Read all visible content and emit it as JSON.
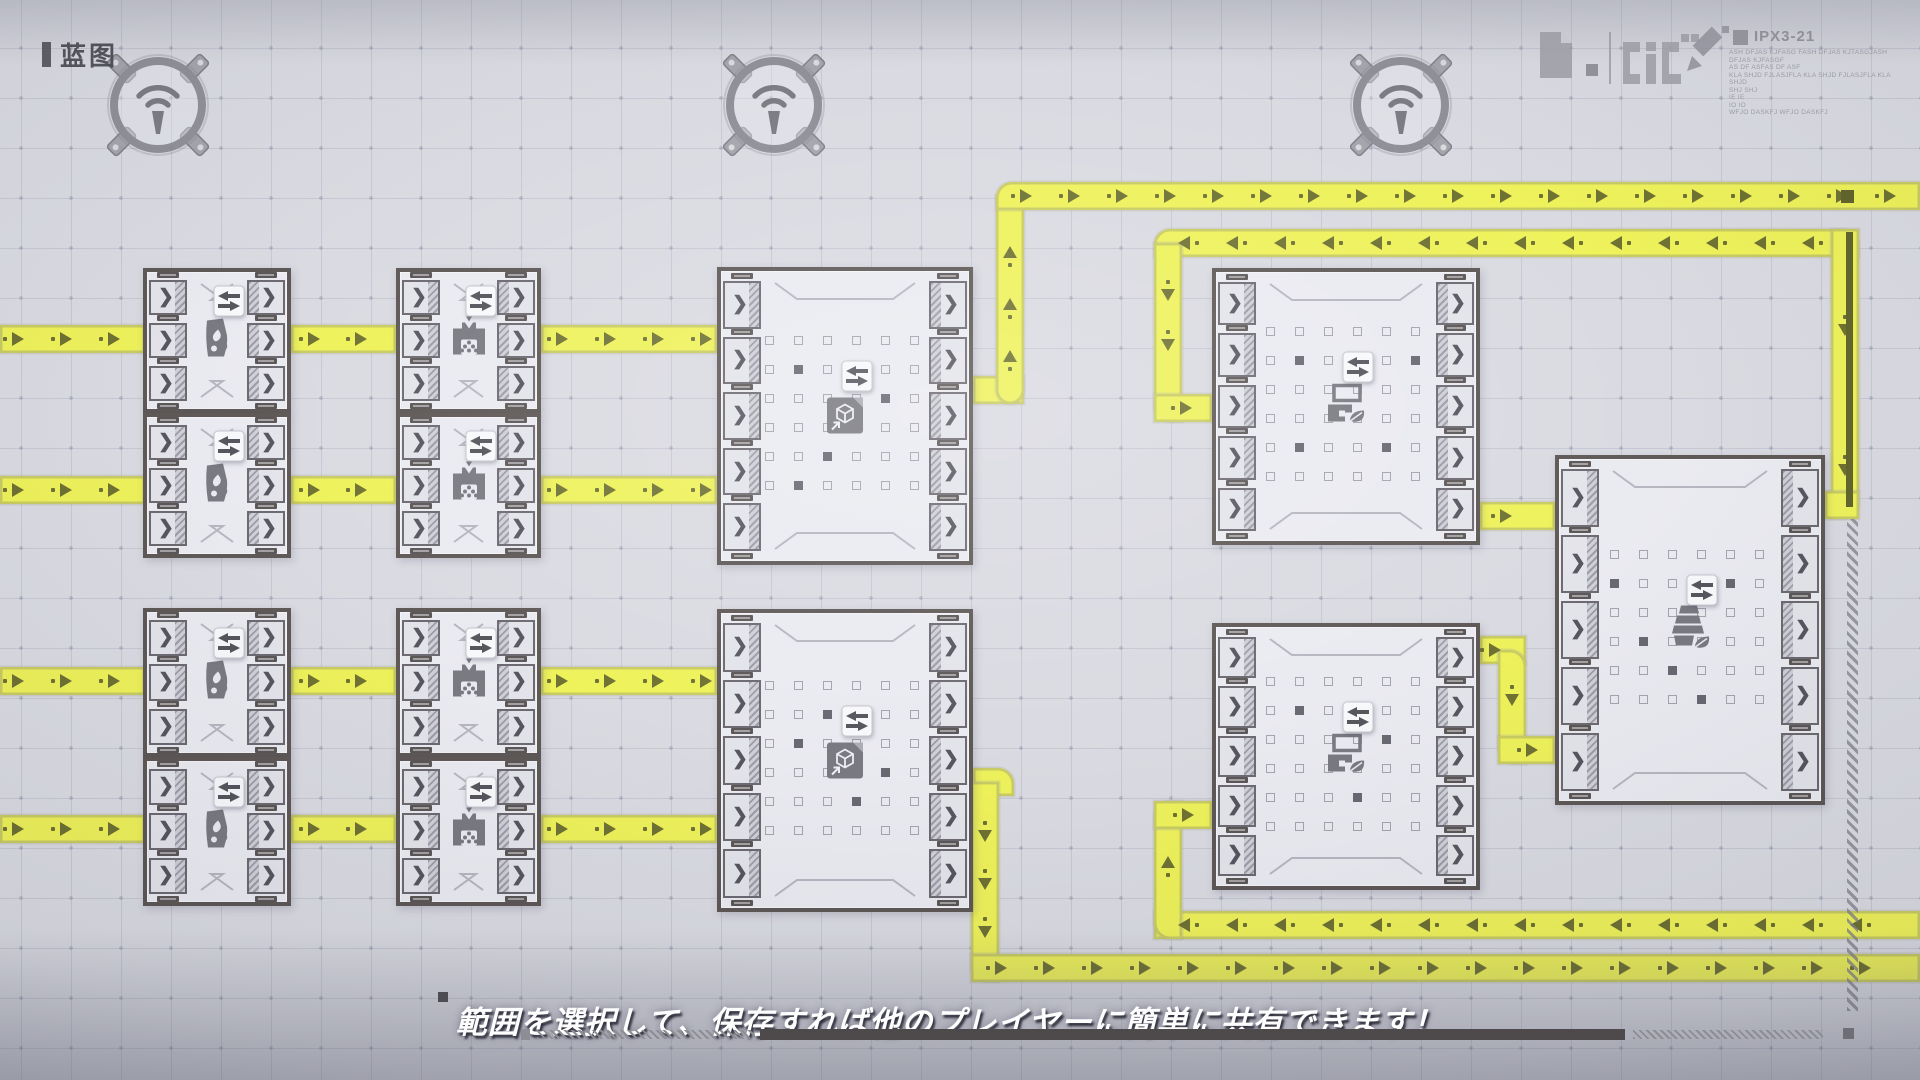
{
  "hud": {
    "blueprint_label": "蓝图",
    "ipx_code": "IPX3-21",
    "info_lines": [
      "ASH DFJAS KJFASG FASH DFJAS KJTASGJASH DFJAS KJFASGF",
      "AS DF ASFAS DF ASF",
      "KLA SHJD FJLASJFLA KLA SHJD FJLASJFLA KLA SHJD",
      "SHJ SHJ",
      "IE IE",
      "IO IO",
      "WFJO DASKFJ WFJO DASKFJ"
    ],
    "subtitle": "範囲を選択して、保存すれば他のプレイヤーに簡単に共有できます！"
  },
  "colors": {
    "background": "#d8d9e0",
    "belt_yellow": "#edf152",
    "belt_arrow": "#686b28",
    "block_border": "#56504e",
    "icon_gray": "#73737b",
    "label_dark": "#484850"
  },
  "scene": {
    "towers": [
      {
        "x": 158,
        "y": 105
      },
      {
        "x": 774,
        "y": 105
      },
      {
        "x": 1401,
        "y": 105
      }
    ],
    "blocks": [
      {
        "icon": "furnace",
        "x": 143,
        "y": 268,
        "w": 148,
        "h": 145,
        "ports": 3
      },
      {
        "icon": "furnace",
        "x": 143,
        "y": 413,
        "w": 148,
        "h": 145,
        "ports": 3
      },
      {
        "icon": "crusher",
        "x": 396,
        "y": 268,
        "w": 145,
        "h": 145,
        "ports": 3
      },
      {
        "icon": "crusher",
        "x": 396,
        "y": 413,
        "w": 145,
        "h": 145,
        "ports": 3
      },
      {
        "icon": "furnace",
        "x": 143,
        "y": 608,
        "w": 148,
        "h": 149,
        "ports": 3
      },
      {
        "icon": "furnace",
        "x": 143,
        "y": 757,
        "w": 148,
        "h": 149,
        "ports": 3
      },
      {
        "icon": "crusher",
        "x": 396,
        "y": 608,
        "w": 145,
        "h": 149,
        "ports": 3
      },
      {
        "icon": "crusher",
        "x": 396,
        "y": 757,
        "w": 145,
        "h": 149,
        "ports": 3
      },
      {
        "icon": "storage",
        "x": 717,
        "y": 267,
        "w": 256,
        "h": 298,
        "ports": 5,
        "dots": true,
        "dots_filled": [
          7,
          16,
          21,
          26,
          31
        ]
      },
      {
        "icon": "storage",
        "x": 717,
        "y": 609,
        "w": 256,
        "h": 303,
        "ports": 5,
        "dots": true,
        "dots_filled": [
          8,
          13,
          22,
          27
        ]
      },
      {
        "icon": "leafmachine",
        "x": 1212,
        "y": 268,
        "w": 268,
        "h": 277,
        "ports": 5,
        "dots": true,
        "dots_filled": [
          7,
          11,
          25,
          28
        ]
      },
      {
        "icon": "leafmachine",
        "x": 1212,
        "y": 623,
        "w": 268,
        "h": 267,
        "ports": 5,
        "dots": true,
        "dots_filled": [
          7,
          16,
          27
        ]
      },
      {
        "icon": "farm",
        "x": 1555,
        "y": 455,
        "w": 270,
        "h": 350,
        "ports": 5,
        "dots": true,
        "dots_filled": [
          6,
          10,
          19,
          26,
          33
        ]
      }
    ],
    "belts": {
      "width": 28,
      "segments": [
        {
          "o": "h",
          "x": 0,
          "y": 339,
          "len": 145,
          "flow": "r",
          "arrows": [
            18,
            66,
            114
          ]
        },
        {
          "o": "h",
          "x": 291,
          "y": 339,
          "len": 105,
          "flow": "r",
          "arrows": [
            314,
            361
          ]
        },
        {
          "o": "h",
          "x": 541,
          "y": 339,
          "len": 176,
          "flow": "r",
          "arrows": [
            562,
            610,
            658,
            706
          ]
        },
        {
          "o": "h",
          "x": 0,
          "y": 490,
          "len": 145,
          "flow": "r",
          "arrows": [
            18,
            66,
            114
          ]
        },
        {
          "o": "h",
          "x": 291,
          "y": 490,
          "len": 105,
          "flow": "r",
          "arrows": [
            314,
            361
          ]
        },
        {
          "o": "h",
          "x": 541,
          "y": 490,
          "len": 176,
          "flow": "r",
          "arrows": [
            562,
            610,
            658,
            706
          ]
        },
        {
          "o": "h",
          "x": 0,
          "y": 681,
          "len": 145,
          "flow": "r",
          "arrows": [
            18,
            66,
            114
          ]
        },
        {
          "o": "h",
          "x": 291,
          "y": 681,
          "len": 105,
          "flow": "r",
          "arrows": [
            314,
            361
          ]
        },
        {
          "o": "h",
          "x": 541,
          "y": 681,
          "len": 176,
          "flow": "r",
          "arrows": [
            562,
            610,
            658,
            706
          ]
        },
        {
          "o": "h",
          "x": 0,
          "y": 829,
          "len": 145,
          "flow": "r",
          "arrows": [
            18,
            66,
            114
          ]
        },
        {
          "o": "h",
          "x": 291,
          "y": 829,
          "len": 105,
          "flow": "r",
          "arrows": [
            314,
            361
          ]
        },
        {
          "o": "h",
          "x": 541,
          "y": 829,
          "len": 176,
          "flow": "r",
          "arrows": [
            562,
            610,
            658,
            706
          ]
        },
        {
          "o": "h",
          "x": 973,
          "y": 390,
          "len": 51,
          "flow": "r",
          "arrows": []
        },
        {
          "o": "v",
          "x": 1010,
          "y": 196,
          "len": 208,
          "flow": "u",
          "arrows": [
            252,
            304,
            356
          ],
          "round": "bl br"
        },
        {
          "o": "h",
          "x": 996,
          "y": 196,
          "len": 924,
          "flow": "r",
          "arrows": "auto",
          "round": "tl"
        },
        {
          "o": "h",
          "x": 1154,
          "y": 243,
          "len": 705,
          "flow": "l",
          "arrows": "auto",
          "round": "tl tr"
        },
        {
          "o": "v",
          "x": 1168,
          "y": 243,
          "len": 179,
          "flow": "d",
          "arrows": [
            295,
            345
          ],
          "round": "bl"
        },
        {
          "o": "h",
          "x": 1154,
          "y": 408,
          "len": 58,
          "flow": "r",
          "arrows": [
            1186
          ]
        },
        {
          "o": "v",
          "x": 1845,
          "y": 229,
          "len": 290,
          "flow": "d",
          "arrows": [
            330,
            470
          ],
          "round": "br"
        },
        {
          "o": "h",
          "x": 1825,
          "y": 505,
          "len": 34,
          "flow": "l",
          "arrows": []
        },
        {
          "o": "h",
          "x": 1480,
          "y": 516,
          "len": 75,
          "flow": "r",
          "arrows": [
            1506
          ]
        },
        {
          "o": "h",
          "x": 1480,
          "y": 650,
          "len": 46,
          "flow": "r",
          "arrows": [
            1495
          ]
        },
        {
          "o": "v",
          "x": 1512,
          "y": 650,
          "len": 114,
          "flow": "d",
          "arrows": [
            700
          ],
          "round": "tr bl"
        },
        {
          "o": "h",
          "x": 1498,
          "y": 750,
          "len": 57,
          "flow": "r",
          "arrows": [
            1532
          ]
        },
        {
          "o": "h",
          "x": 973,
          "y": 782,
          "len": 41,
          "flow": "r",
          "arrows": [],
          "round": "tr"
        },
        {
          "o": "v",
          "x": 985,
          "y": 782,
          "len": 200,
          "flow": "d",
          "arrows": [
            836,
            884,
            932
          ],
          "round": "bl"
        },
        {
          "o": "h",
          "x": 971,
          "y": 968,
          "len": 949,
          "flow": "r",
          "arrows": "auto"
        },
        {
          "o": "h",
          "x": 1154,
          "y": 925,
          "len": 766,
          "flow": "l",
          "arrows": "auto"
        },
        {
          "o": "v",
          "x": 1168,
          "y": 801,
          "len": 138,
          "flow": "u",
          "arrows": [
            862
          ],
          "round": "tl bl"
        },
        {
          "o": "h",
          "x": 1154,
          "y": 815,
          "len": 58,
          "flow": "r",
          "arrows": [
            1188
          ]
        }
      ],
      "item_queue_line": {
        "x": 1846,
        "y": 232,
        "w": 7,
        "h": 275
      },
      "item_cube": {
        "x": 1841,
        "y": 190,
        "w": 13,
        "h": 13
      }
    },
    "decor": {
      "hazard_vertical": {
        "x": 1847,
        "y": 519,
        "w": 11,
        "h": 492
      },
      "bottom_elements": [
        {
          "type": "square",
          "x": 438,
          "y": 992,
          "w": 10,
          "h": 10,
          "c": "#4c4c52"
        },
        {
          "type": "square",
          "x": 521,
          "y": 1029,
          "w": 9,
          "h": 11,
          "c": "#8d8d95"
        },
        {
          "type": "hatch",
          "x": 537,
          "y": 1030,
          "w": 218,
          "h": 9
        },
        {
          "type": "bar",
          "x": 760,
          "y": 1029,
          "w": 865,
          "h": 11,
          "c": "#4e494b"
        },
        {
          "type": "hatch",
          "x": 1633,
          "y": 1030,
          "w": 190,
          "h": 9
        },
        {
          "type": "square",
          "x": 1843,
          "y": 1028,
          "w": 11,
          "h": 11,
          "c": "#6e6e76"
        }
      ]
    }
  }
}
